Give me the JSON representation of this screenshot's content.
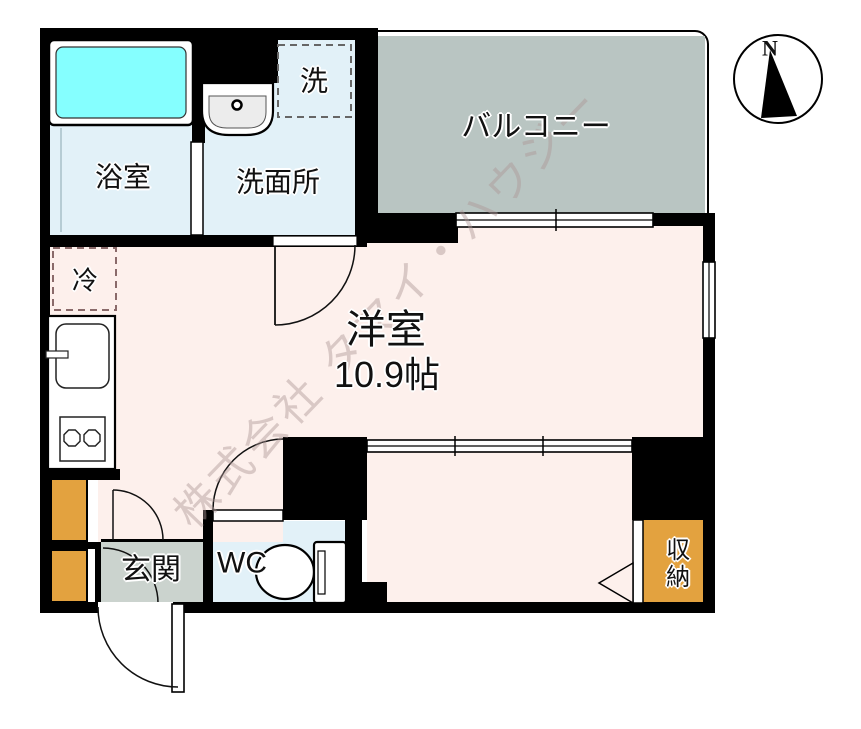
{
  "title": "1R floor plan",
  "rooms": {
    "bathroom": {
      "label": "浴室"
    },
    "washroom": {
      "label": "洗面所"
    },
    "laundry": {
      "label": "洗"
    },
    "balcony": {
      "label": "バルコニー"
    },
    "main_room": {
      "label": "洋室",
      "size": "10.9帖"
    },
    "fridge": {
      "label": "冷"
    },
    "entrance": {
      "label": "玄関"
    },
    "toilet": {
      "label": "WC"
    },
    "storage": {
      "label": "収納"
    }
  },
  "compass": {
    "north_label": "N"
  },
  "watermark": {
    "text": "株式会社 タマイ・ハウジー"
  },
  "colors": {
    "wall": "#000000",
    "pink": "#fdf0ec",
    "blue": "#e2f1f8",
    "balcony": "#b9c5c2",
    "genkan": "#cbd3ce",
    "orange": "#e3a23f",
    "tub": "#85ffff"
  }
}
